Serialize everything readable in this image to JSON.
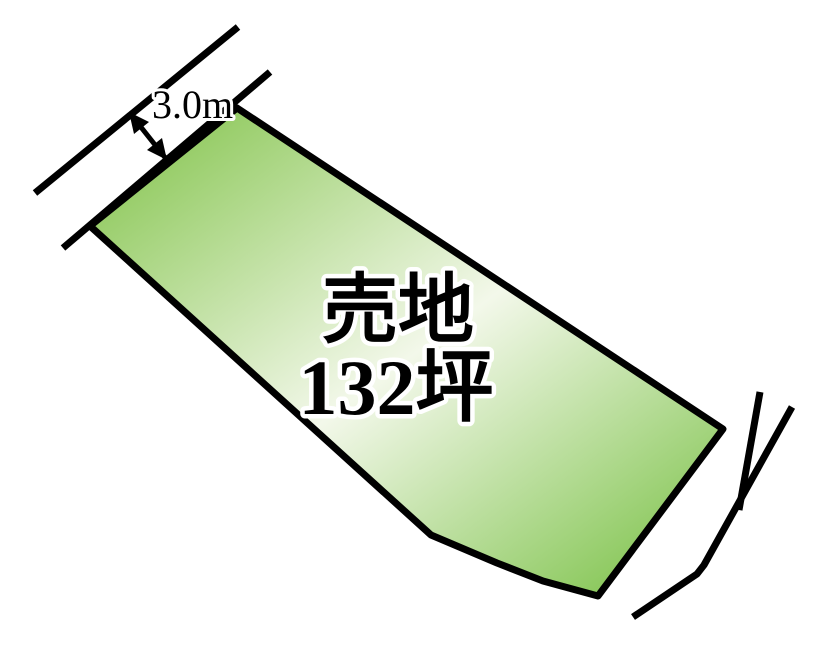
{
  "diagram": {
    "kind": "land-plot-sale-diagram",
    "colors": {
      "background": "#ffffff",
      "line": "#000000",
      "text": "#000000",
      "text_outline": "#ffffff",
      "parcel_gradient_start": "#97cd68",
      "parcel_gradient_middle": "#f3f8ea",
      "parcel_gradient_end": "#8cc95e"
    },
    "parcel": {
      "label_line1": "売地",
      "label_line2": "132坪",
      "area_value": "132",
      "area_unit": "坪",
      "points": "237,108 723,429 598,596 543,581 497,563 431,535 90,226"
    },
    "dimension": {
      "label": "3.0m",
      "shaft_points": "129,112 167,160",
      "arrowhead_upper_points": "129,112 134,134 149,122",
      "arrowhead_lower_points": "167,160 147,150 162,138"
    },
    "roads": {
      "top_left_outer": "35,193 238,27",
      "top_left_inner": "63,248 270,72",
      "bottom_right_inner": "760,392 739,510",
      "bottom_right_outer": "792,407 704,565 697,574 633,617"
    }
  }
}
